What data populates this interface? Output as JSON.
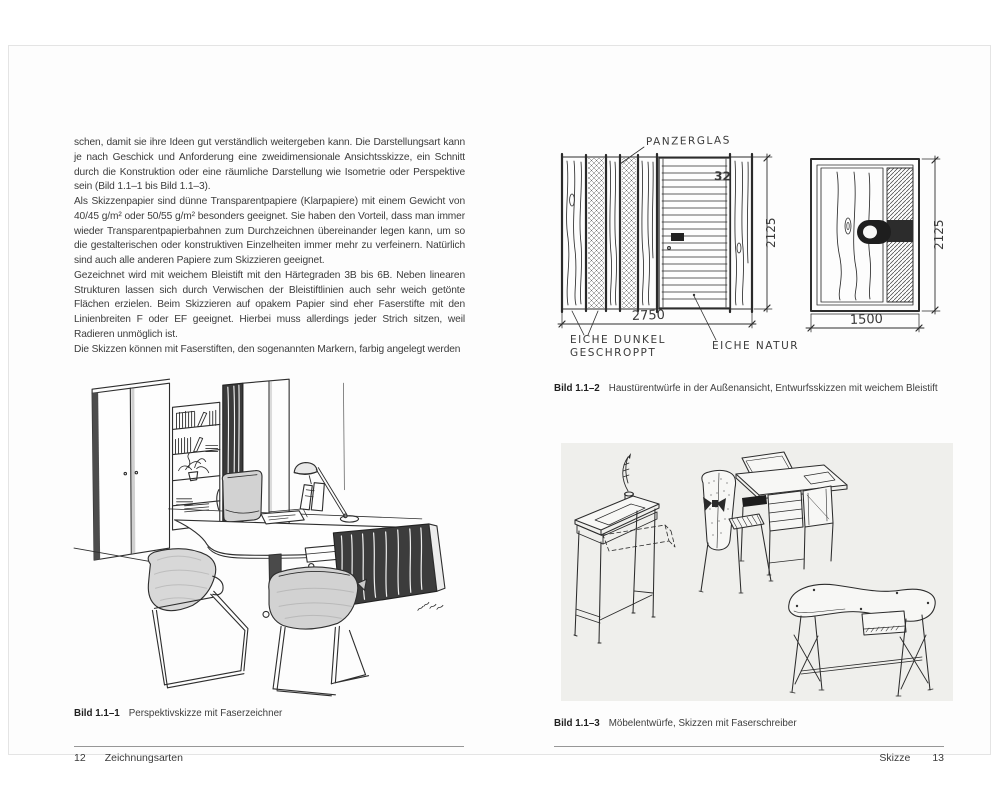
{
  "colors": {
    "page_background": "#fdfdfd",
    "figure_box_background": "#efefec",
    "ink": "#2d2d2d",
    "footer_rule": "#979797"
  },
  "spread": {
    "left": {
      "paragraphs": [
        "schen, damit sie ihre Ideen gut verständlich weitergeben kann. Die Darstellungsart kann je nach Geschick und Anforderung eine zweidimensionale Ansichtsskizze, ein Schnitt durch die Konstruktion oder eine räumliche Darstellung wie Isometrie oder Perspektive sein (Bild 1.1–1 bis Bild 1.1–3).",
        "Als Skizzenpapier sind dünne Transparentpapiere (Klarpapiere) mit einem Gewicht von 40/45 g/m² oder 50/55 g/m² besonders geeignet. Sie haben den Vorteil, dass man immer wieder Transparentpapierbahnen zum Durchzeichnen übereinander legen kann, um so die gestalterischen oder konstruktiven Einzelheiten immer mehr zu verfeinern. Natürlich sind auch alle anderen Papiere zum Skizzieren geeignet.",
        "Gezeichnet wird mit weichem Bleistift mit den Härtegraden 3B bis 6B. Neben linearen Strukturen lassen sich durch Verwischen der Bleistiftlinien auch sehr weich getönte Flächen erzielen. Beim Skizzieren auf opakem Papier sind eher Faserstifte mit den Linienbreiten F oder EF geeignet. Hierbei muss allerdings jeder Strich sitzen, weil Radieren unmöglich ist.",
        "Die Skizzen können mit Faserstiften, den sogenannten Markern, farbig angelegt werden"
      ],
      "figure_caption": {
        "label": "Bild 1.1–1",
        "text": "Perspektivskizze mit Faserzeichner"
      },
      "footer": {
        "page_number": "12",
        "chapter": "Zeichnungsarten"
      }
    },
    "right": {
      "figure_top_caption": {
        "label": "Bild 1.1–2",
        "text": "Haustürentwürfe in der Außenansicht, Entwurfsskizzen mit weichem Bleistift"
      },
      "figure_bottom_caption": {
        "label": "Bild 1.1–3",
        "text": "Möbelentwürfe, Skizzen mit Faserschreiber"
      },
      "footer": {
        "chapter": "Skizze",
        "page_number": "13"
      },
      "door_sketch": {
        "label_panzerglas": "PANZERGLAS",
        "label_eiche_dunkel": "EICHE DUNKEL",
        "label_geschroppt": "GESCHROPPT",
        "label_eiche_natur": "EICHE NATUR",
        "dim_left_width": "2750",
        "dim_left_height": "2125",
        "dim_right_width": "1500",
        "dim_right_height": "2125",
        "house_number": "32"
      }
    }
  }
}
